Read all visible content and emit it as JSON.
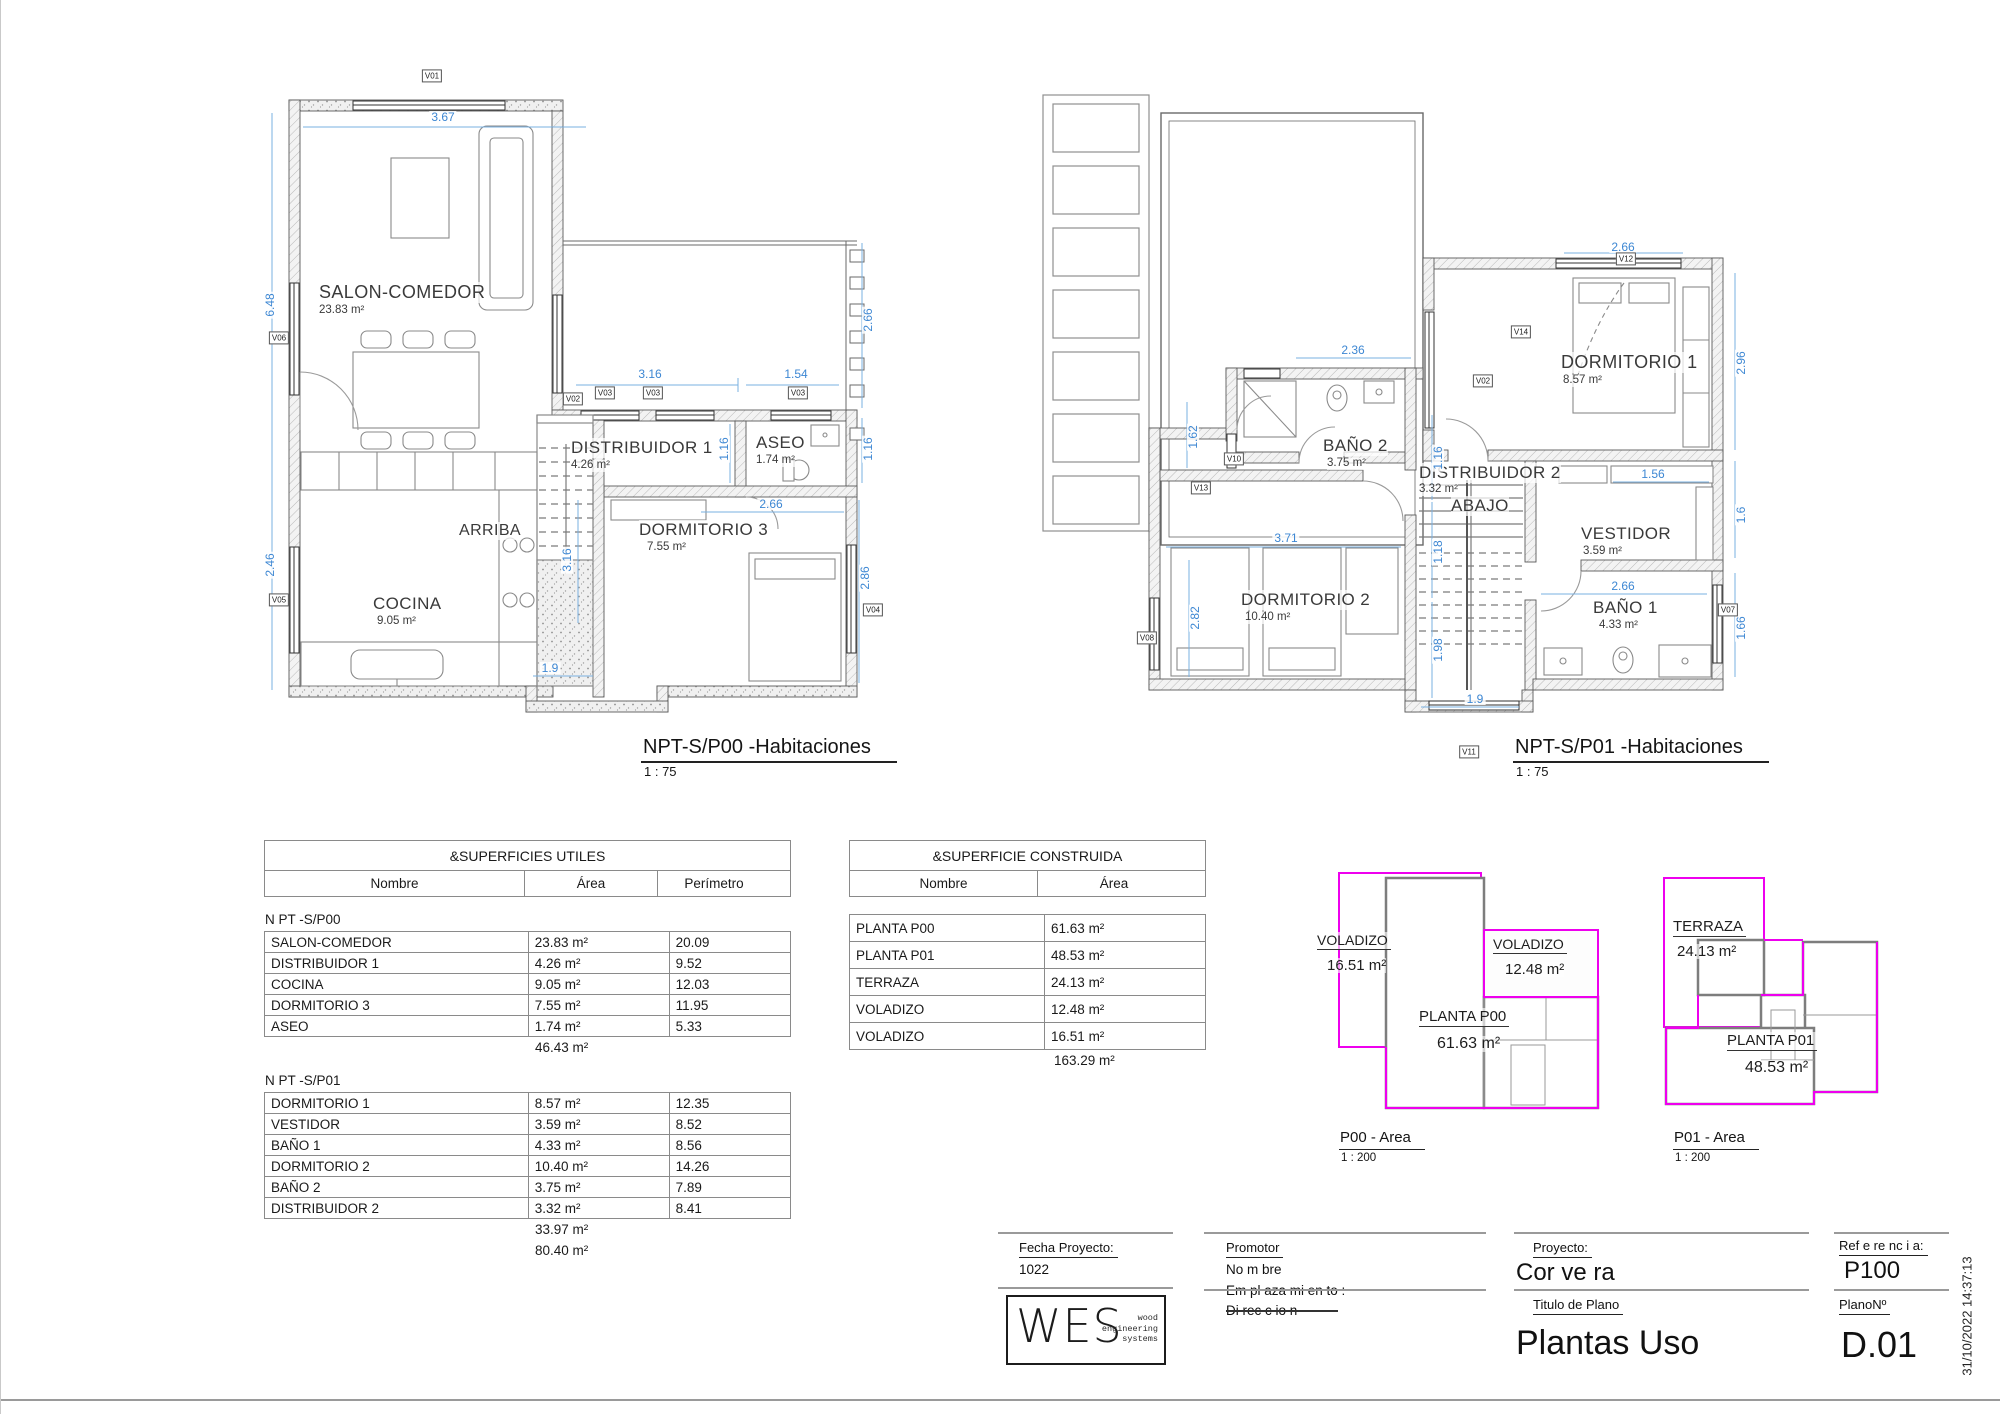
{
  "plan_p00": {
    "title": "NPT-S/P00 -Habitaciones",
    "scale": "1 : 75",
    "stair_label": "ARRIBA",
    "rooms": [
      {
        "name": "SALON-COMEDOR",
        "area": "23.83 m²"
      },
      {
        "name": "DISTRIBUIDOR 1",
        "area": "4.26 m²"
      },
      {
        "name": "ASEO",
        "area": "1.74 m²"
      },
      {
        "name": "DORMITORIO 3",
        "area": "7.55 m²"
      },
      {
        "name": "COCINA",
        "area": "9.05 m²"
      }
    ],
    "dims": [
      "3.67",
      "6.48",
      "2.46",
      "3.16",
      "1.54",
      "2.66",
      "1.16",
      "1.16",
      "2.66",
      "2.86",
      "3.16",
      "1.9"
    ],
    "windows": [
      "V01",
      "V06",
      "V05",
      "V02",
      "V03",
      "V03",
      "V03",
      "V04"
    ]
  },
  "plan_p01": {
    "title": "NPT-S/P01 -Habitaciones",
    "scale": "1 : 75",
    "stair_label": "ABAJO",
    "rooms": [
      {
        "name": "BAÑO 2",
        "area": "3.75 m²"
      },
      {
        "name": "DORMITORIO 1",
        "area": "8.57 m²"
      },
      {
        "name": "DISTRIBUIDOR 2",
        "area": "3.32 m²"
      },
      {
        "name": "VESTIDOR",
        "area": "3.59 m²"
      },
      {
        "name": "DORMITORIO 2",
        "area": "10.40 m²"
      },
      {
        "name": "BAÑO 1",
        "area": "4.33 m²"
      }
    ],
    "dims": [
      "2.66",
      "2.96",
      "2.36",
      "1.62",
      "1.16",
      "3.71",
      "1.18",
      "1.56",
      "1.6",
      "2.82",
      "2.66",
      "1.98",
      "1.66",
      "1.9"
    ],
    "windows": [
      "V12",
      "V14",
      "V02",
      "V10",
      "V13",
      "V08",
      "V11",
      "V07"
    ]
  },
  "table_utiles": {
    "title": "&SUPERFICIES UTILES",
    "headers": [
      "Nombre",
      "Área",
      "Perímetro"
    ],
    "group1": {
      "label": "N PT -S/P00",
      "rows": [
        [
          "SALON-COMEDOR",
          "23.83 m²",
          "20.09"
        ],
        [
          "DISTRIBUIDOR 1",
          "4.26 m²",
          "9.52"
        ],
        [
          "COCINA",
          "9.05 m²",
          "12.03"
        ],
        [
          "DORMITORIO 3",
          "7.55 m²",
          "11.95"
        ],
        [
          "ASEO",
          "1.74 m²",
          "5.33"
        ]
      ],
      "subtotal": "46.43 m²"
    },
    "group2": {
      "label": "N PT -S/P01",
      "rows": [
        [
          "DORMITORIO 1",
          "8.57 m²",
          "12.35"
        ],
        [
          "VESTIDOR",
          "3.59 m²",
          "8.52"
        ],
        [
          "BAÑO 1",
          "4.33 m²",
          "8.56"
        ],
        [
          "DORMITORIO 2",
          "10.40 m²",
          "14.26"
        ],
        [
          "BAÑO 2",
          "3.75 m²",
          "7.89"
        ],
        [
          "DISTRIBUIDOR 2",
          "3.32 m²",
          "8.41"
        ]
      ],
      "subtotal": "33.97 m²"
    },
    "total": "80.40 m²"
  },
  "table_construida": {
    "title": "&SUPERFICIE CONSTRUIDA",
    "headers": [
      "Nombre",
      "Área"
    ],
    "rows": [
      [
        "PLANTA P00",
        "61.63 m²"
      ],
      [
        "PLANTA P01",
        "48.53 m²"
      ],
      [
        "TERRAZA",
        "24.13 m²"
      ],
      [
        "VOLADIZO",
        "12.48 m²"
      ],
      [
        "VOLADIZO",
        "16.51 m²"
      ]
    ],
    "total": "163.29 m²"
  },
  "area_p00": {
    "title": "P00 - Area",
    "scale": "1 : 200",
    "labels": [
      {
        "name": "VOLADIZO",
        "area": "16.51 m²"
      },
      {
        "name": "VOLADIZO",
        "area": "12.48 m²"
      },
      {
        "name": "PLANTA P00",
        "area": "61.63 m²"
      }
    ]
  },
  "area_p01": {
    "title": "P01 - Area",
    "scale": "1 : 200",
    "labels": [
      {
        "name": "TERRAZA",
        "area": "24.13 m²"
      },
      {
        "name": "PLANTA P01",
        "area": "48.53 m²"
      }
    ]
  },
  "titleblock": {
    "fecha_label": "Fecha Proyecto:",
    "fecha_value": "1022",
    "logo_text": "WES",
    "logo_sub1": "wood",
    "logo_sub2": "engineering",
    "logo_sub3": "systems",
    "promotor_label": "Promotor",
    "promotor_nombre": "No m bre",
    "promotor_emplazamiento": "Em pl aza mi en to :",
    "promotor_direccion": "Di rec c io n",
    "proyecto_label": "Proyecto:",
    "proyecto_value": "Cor ve ra",
    "titulo_label": "Titulo de Plano",
    "titulo_value": "Plantas Uso",
    "referencia_label": "Ref e re nc i a:",
    "referencia_value": "P100",
    "plano_label": "PlanoNº",
    "plano_value": "D.01",
    "timestamp": "31/10/2022 14:37:13"
  },
  "colors": {
    "dimension_blue": "#3d87d3",
    "area_magenta": "#ee00ee",
    "wall_stroke": "#5a5a5a",
    "table_border": "#8a8a8a"
  }
}
